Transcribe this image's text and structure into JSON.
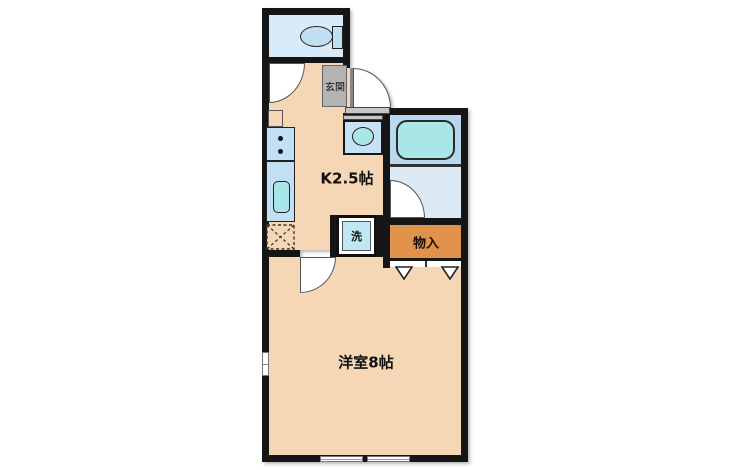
{
  "floor_plan": {
    "rooms": {
      "kitchen": {
        "label": "K2.5帖"
      },
      "western_room": {
        "label": "洋室8帖"
      },
      "entrance": {
        "label": "玄関"
      },
      "storage": {
        "label": "物入"
      },
      "washer": {
        "label": "洗"
      }
    },
    "colors": {
      "wall": "#151515",
      "floor_peach": "#F5D6B5",
      "toilet_room_blue": "#D9EAF8",
      "bath_upper_blue": "#B9D8F0",
      "bath_lower_blue": "#DCEAF6",
      "tub_cyan": "#A9E6E8",
      "fixture_blue": "#C3DFF3",
      "washer_cyan": "#BFE9F2",
      "storage_orange": "#E0914A",
      "genkan_gray": "#B3B3B3",
      "step_gray": "#C6C6C6"
    },
    "fixtures": [
      "toilet-icon",
      "bathtub-icon",
      "washbasin-icon",
      "stove-icon",
      "kitchen-sink-icon",
      "fridge-space-icon",
      "door-arc",
      "window",
      "closet-door-marks",
      "entrance-step"
    ]
  }
}
